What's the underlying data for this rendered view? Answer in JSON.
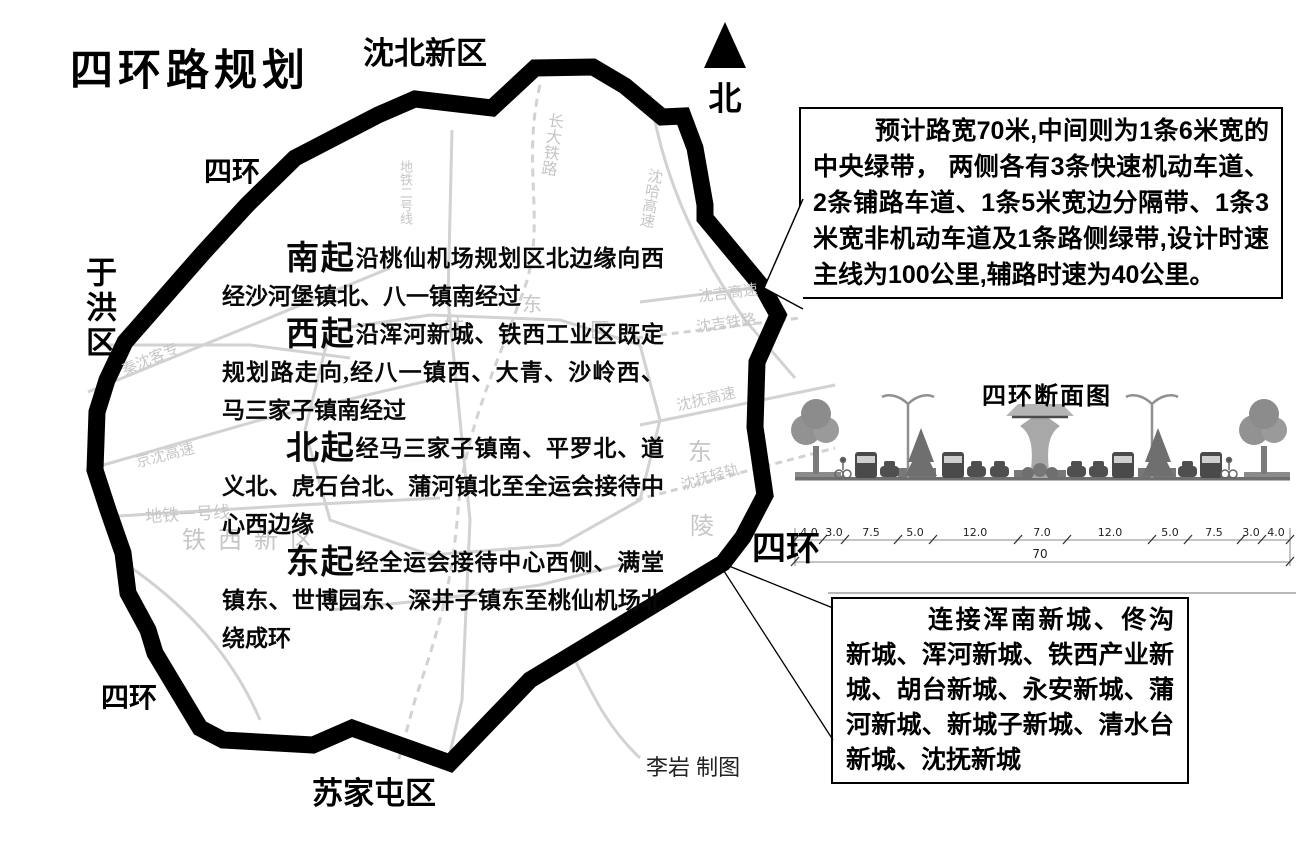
{
  "page": {
    "title": "四环路规划",
    "credit": "李岩  制图"
  },
  "north_label": "北",
  "districts": {
    "shenbei": "沈北新区",
    "yuhong": "于洪区",
    "sujiatun": "苏家屯区"
  },
  "ring_labels": {
    "top_left": "四环",
    "bottom_left": "四环",
    "right": "四环"
  },
  "route_paragraphs": [
    {
      "lead": "南起",
      "text": "沿桃仙机场规划区北边缘向西经沙河堡镇北、八一镇南经过"
    },
    {
      "lead": "西起",
      "text": "沿浑河新城、铁西工业区既定规划路走向,经八一镇西、大青、沙岭西、马三家子镇南经过"
    },
    {
      "lead": "北起",
      "text": "经马三家子镇南、平罗北、道义北、虎石台北、蒲河镇北至全运会接待中心西边缘"
    },
    {
      "lead": "东起",
      "text": "经全运会接待中心西侧、满堂镇东、世博园东、深井子镇东至桃仙机场北绕成环"
    }
  ],
  "callout_road_spec": {
    "text": "预计路宽70米,中间则为1条6米宽的中央绿带， 两侧各有3条快速机动车道、2条铺路车道、1条5米宽边分隔带、1条3米宽非机动车道及1条路侧绿带,设计时速主线为100公里,辅路时速为40公里。"
  },
  "callout_connections": {
    "text": "连接浑南新城、佟沟新城、浑河新城、铁西产业新城、胡台新城、永安新城、蒲河新城、新城子新城、清水台新城、沈抚新城"
  },
  "cross_section": {
    "title": "四环断面图",
    "dimensions": [
      "4.0",
      "3.0",
      "7.5",
      "5.0",
      "12.0",
      "7.0",
      "12.0",
      "5.0",
      "7.5",
      "3.0",
      "4.0"
    ],
    "total_width": "70"
  },
  "background_map_labels": {
    "changda_railway": "长大铁路",
    "shenha_expwy": "沈哈高速",
    "shenji_expwy": "沈吉高速",
    "shenji_railway": "沈吉铁路",
    "shenfu_expwy": "沈抚高速",
    "shenfu_lightrail": "沈抚轻轨",
    "qinshen_railway": "秦沈客专",
    "jingshen_expwy": "京沈高速",
    "metro_line1": "地铁一号线",
    "metro_line2": "地铁二号线",
    "tiexi_district": "铁西新区",
    "dong_char": "东",
    "ling_char": "陵",
    "gu_char": "姑",
    "dong2_char": "东",
    "qu_char": "区"
  },
  "colors": {
    "ring_road": "#000000",
    "faint_map": "#c6c6c6",
    "box_border": "#000000"
  }
}
